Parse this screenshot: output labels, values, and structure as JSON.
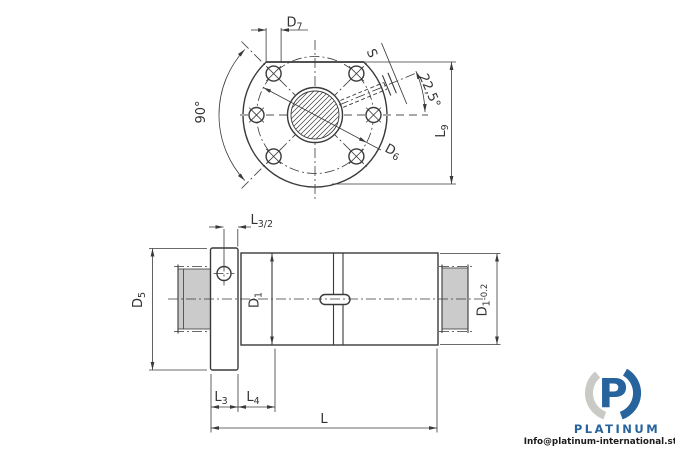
{
  "drawing": {
    "front_view": {
      "labels": {
        "d7": {
          "main": "D",
          "sub": "7"
        },
        "s": {
          "main": "S"
        },
        "angle": {
          "text": "22,5°"
        },
        "l9": {
          "main": "L",
          "sub": "9"
        },
        "d6": {
          "main": "D",
          "sub": "6"
        },
        "angle90": {
          "text": "90°"
        }
      }
    },
    "side_view": {
      "labels": {
        "l3_half": {
          "main": "L",
          "sub": "3/2"
        },
        "d5": {
          "main": "D",
          "sub": "5"
        },
        "d1": {
          "main": "D",
          "sub": "1"
        },
        "d1_tol": {
          "main": "D",
          "sub": "1",
          "tol": "-0.2"
        },
        "l3": {
          "main": "L",
          "sub": "3"
        },
        "l4": {
          "main": "L",
          "sub": "4"
        },
        "l": {
          "main": "L"
        }
      }
    }
  },
  "watermark": {
    "logo_letter": "P",
    "brand": "PLATINUM",
    "email": "Info@platinum-international.store"
  },
  "colors": {
    "line": "#3a3a3a",
    "accent_blue": "#27639d",
    "logo_gray": "#c9c9c5",
    "stub_fill": "#cbcbcb",
    "centerline_gray": "#a8a8a8"
  }
}
